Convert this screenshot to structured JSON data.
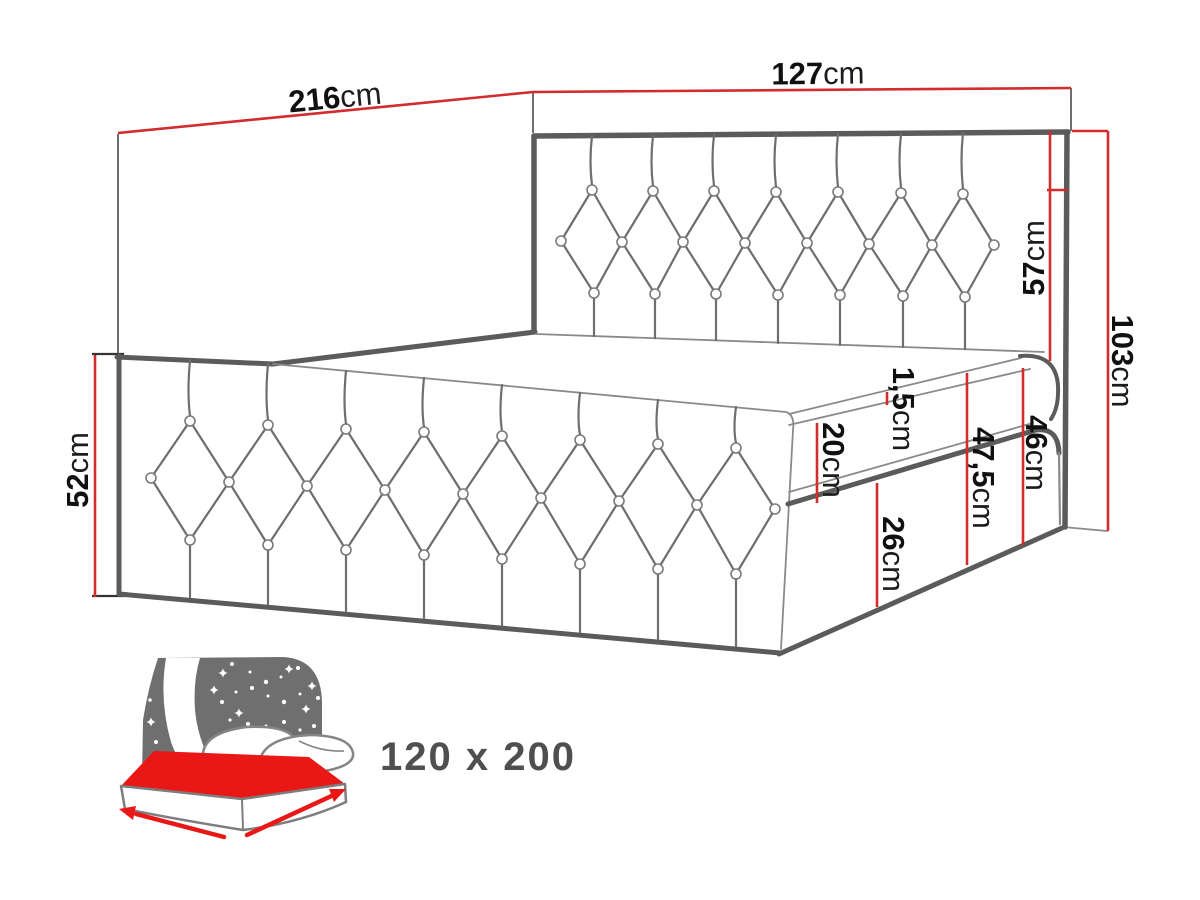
{
  "diagram": {
    "dims": {
      "d216": {
        "value": "216",
        "unit": "cm"
      },
      "d127": {
        "value": "127",
        "unit": "cm"
      },
      "d57": {
        "value": "57",
        "unit": "cm"
      },
      "d103": {
        "value": "103",
        "unit": "cm"
      },
      "d52": {
        "value": "52",
        "unit": "cm"
      },
      "d15": {
        "value": "1,5",
        "unit": "cm"
      },
      "d20": {
        "value": "20",
        "unit": "cm"
      },
      "d475": {
        "value": "47,5",
        "unit": "cm"
      },
      "d46": {
        "value": "46",
        "unit": "cm"
      },
      "d26": {
        "value": "26",
        "unit": "cm"
      }
    },
    "size_label": "120 x 200",
    "colors": {
      "dimension_red": "#d22c2c",
      "icon_red": "#ea1717",
      "line_gray": "#5b5b5b",
      "icon_gray": "#6f6f6f",
      "label_black": "#101010",
      "size_text_gray": "#4f4f4f"
    }
  }
}
